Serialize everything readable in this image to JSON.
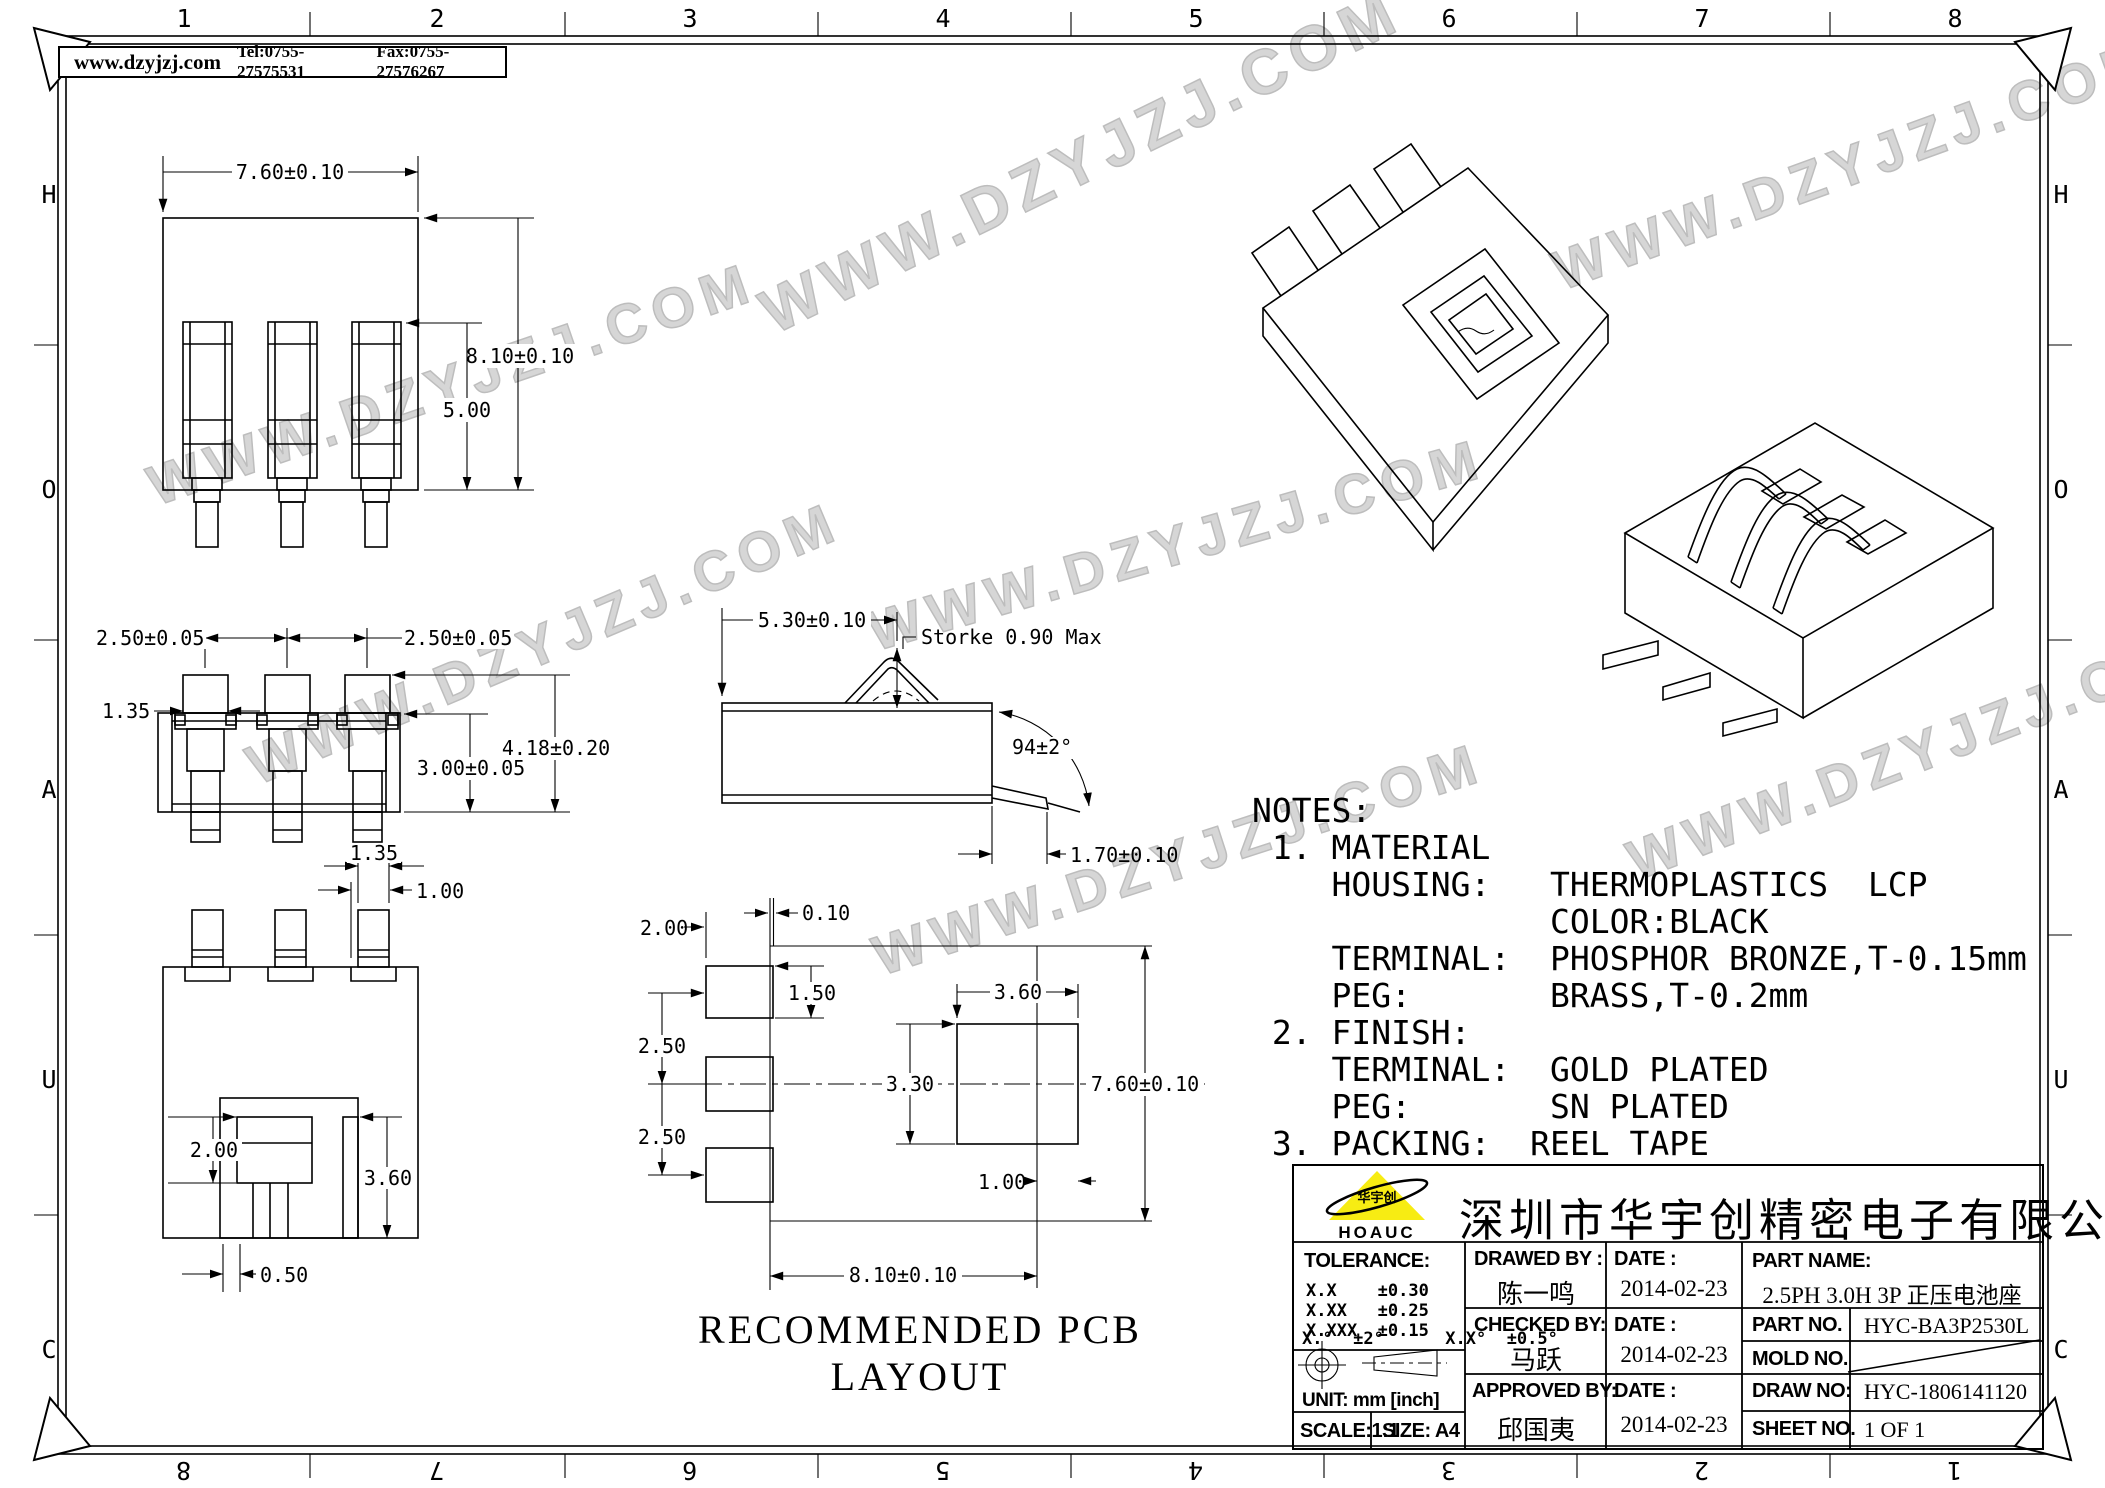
{
  "page": {
    "watermark": "WWW.DZYJZJ.COM"
  },
  "header": {
    "website": "www.dzyjzj.com",
    "tel": "Tel:0755-27575531",
    "fax": "Fax:0755-27576267"
  },
  "border": {
    "top": [
      "1",
      "2",
      "3",
      "4",
      "5",
      "6",
      "7",
      "8"
    ],
    "bottom": [
      "8",
      "7",
      "6",
      "5",
      "4",
      "3",
      "2",
      "1"
    ],
    "left": [
      "H",
      "O",
      "A",
      "U",
      "C"
    ],
    "right": [
      "H",
      "O",
      "A",
      "U",
      "C"
    ]
  },
  "dims": {
    "front_width": "7.60±0.10",
    "front_height": "8.10±0.10",
    "front_slot": "5.00",
    "top_pitch_l": "2.50±0.05",
    "top_pitch_r": "2.50±0.05",
    "top_tab": "1.35",
    "top_body": "3.00±0.05",
    "top_total": "4.18±0.20",
    "bot_tab": "1.35",
    "bot_gap": "1.00",
    "bot_inner": "2.00",
    "bot_slot": "3.60",
    "bot_off": "0.50",
    "side_depth": "5.30±0.10",
    "side_stroke": "Storke 0.90 Max",
    "side_angle": "94±2°",
    "side_pin": "1.70±0.10",
    "pcb_pad_w": "2.00",
    "pcb_gap": "0.10",
    "pcb_pad_h": "1.50",
    "pcb_pitch1": "2.50",
    "pcb_pitch2": "2.50",
    "pcb_slot_w": "3.60",
    "pcb_slot_h": "3.30",
    "pcb_height": "7.60±0.10",
    "pcb_inset": "1.00",
    "pcb_len": "8.10±0.10"
  },
  "notes": {
    "lines": [
      "NOTES:",
      " 1. MATERIAL",
      "    HOUSING:   THERMOPLASTICS  LCP",
      "               COLOR:BLACK",
      "    TERMINAL:  PHOSPHOR BRONZE,T-0.15mm",
      "    PEG:       BRASS,T-0.2mm",
      " 2. FINISH:",
      "    TERMINAL:  GOLD PLATED",
      "    PEG:       SN PLATED",
      " 3. PACKING:  REEL TAPE"
    ]
  },
  "pcb_title": "RECOMMENDED PCB LAYOUT",
  "title_block": {
    "company": "深圳市华宇创精密电子有限公司",
    "logo_text": "HOAUC",
    "logo_mark": "华宇创",
    "tolerance_title": "TOLERANCE:",
    "tol_row1": "X.X    ±0.30",
    "tol_row2": "X.XX   ±0.25",
    "tol_row3": "X.XXX  ±0.15",
    "tol_angles": "X.°  ±2°      X.X°  ±0.5°",
    "unit": "UNIT:  mm  [inch]",
    "scale": "SCALE:1:1",
    "size": "SIZE:  A4",
    "drawed_label": "DRAWED BY :",
    "drawed_name": "陈一鸣",
    "checked_label": "CHECKED BY:",
    "checked_name": "马跃",
    "approved_label": "APPROVED BY:",
    "approved_name": "邱国夷",
    "date_label": "DATE :",
    "date1": "2014-02-23",
    "date2": "2014-02-23",
    "date3": "2014-02-23",
    "part_name_label": "PART NAME:",
    "part_name": "2.5PH 3.0H 3P 正压电池座",
    "part_no_label": "PART NO.",
    "part_no": "HYC-BA3P2530L",
    "mold_no_label": "MOLD NO.",
    "draw_no_label": "DRAW NO:",
    "draw_no": "HYC-1806141120",
    "sheet_no_label": "SHEET NO.",
    "sheet_no": "1 OF 1"
  }
}
